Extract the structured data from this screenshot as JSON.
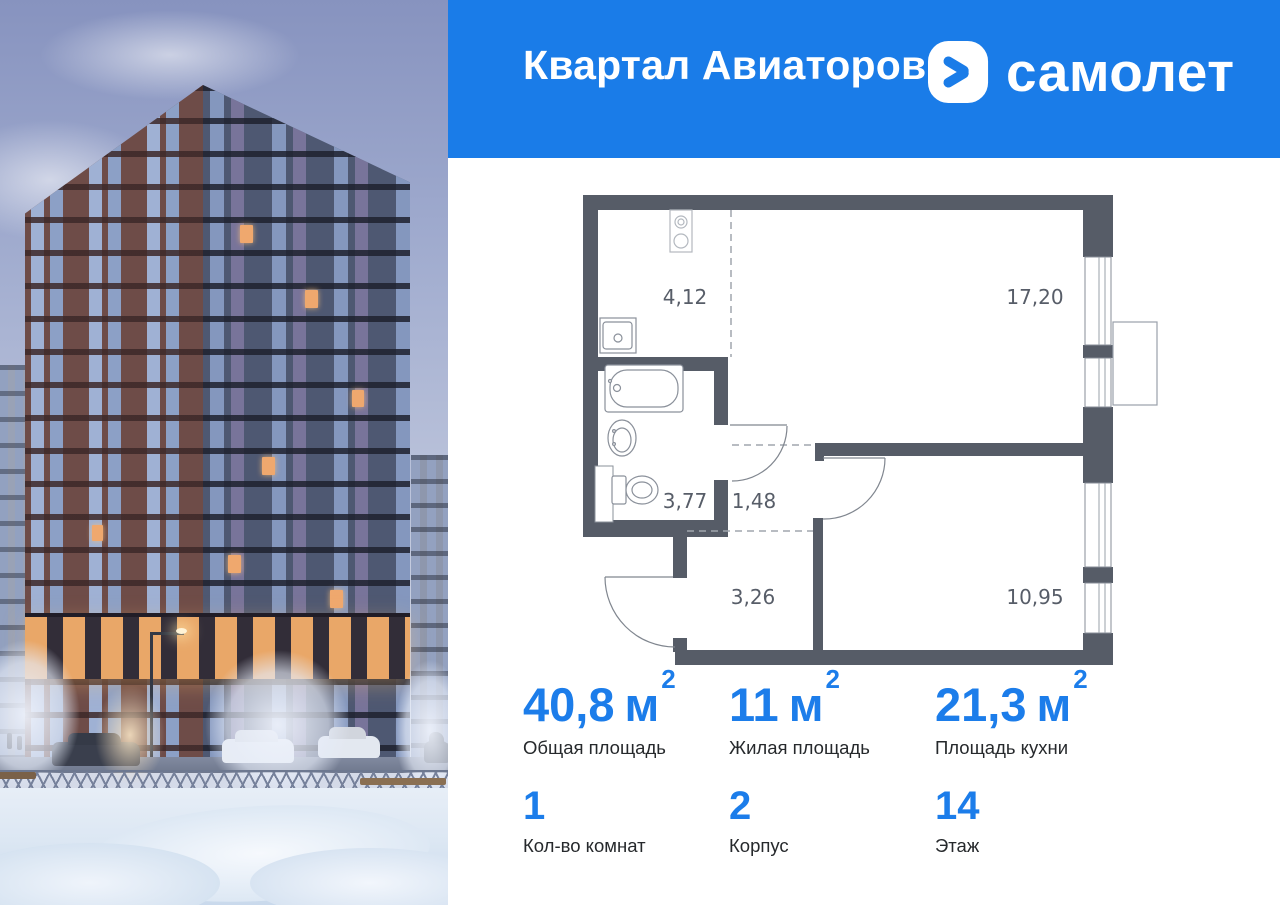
{
  "header": {
    "project_title": "Квартал Авиаторов",
    "brand_name": "самолет"
  },
  "colors": {
    "brand_blue": "#1A7CE8",
    "stat_number_blue": "#1C7DEA",
    "plan_wall_gray": "#565C67"
  },
  "photo": {
    "description": "winter-evening-apartment-tower"
  },
  "floor_plan": {
    "rooms": [
      {
        "name": "kitchen-zone",
        "area": "4,12"
      },
      {
        "name": "living-zone",
        "area": "17,20"
      },
      {
        "name": "bathroom",
        "area": "3,77"
      },
      {
        "name": "hall",
        "area": "1,48"
      },
      {
        "name": "corridor",
        "area": "3,26"
      },
      {
        "name": "bedroom",
        "area": "10,95"
      }
    ]
  },
  "stats": {
    "row1": [
      {
        "value": "40,8",
        "unit": "м",
        "sup": "2",
        "label": "Общая площадь"
      },
      {
        "value": "11",
        "unit": "м",
        "sup": "2",
        "label": "Жилая площадь"
      },
      {
        "value": "21,3",
        "unit": "м",
        "sup": "2",
        "label": "Площадь кухни"
      }
    ],
    "row2": [
      {
        "value": "1",
        "label": "Кол-во комнат"
      },
      {
        "value": "2",
        "label": "Корпус"
      },
      {
        "value": "14",
        "label": "Этаж"
      }
    ]
  }
}
